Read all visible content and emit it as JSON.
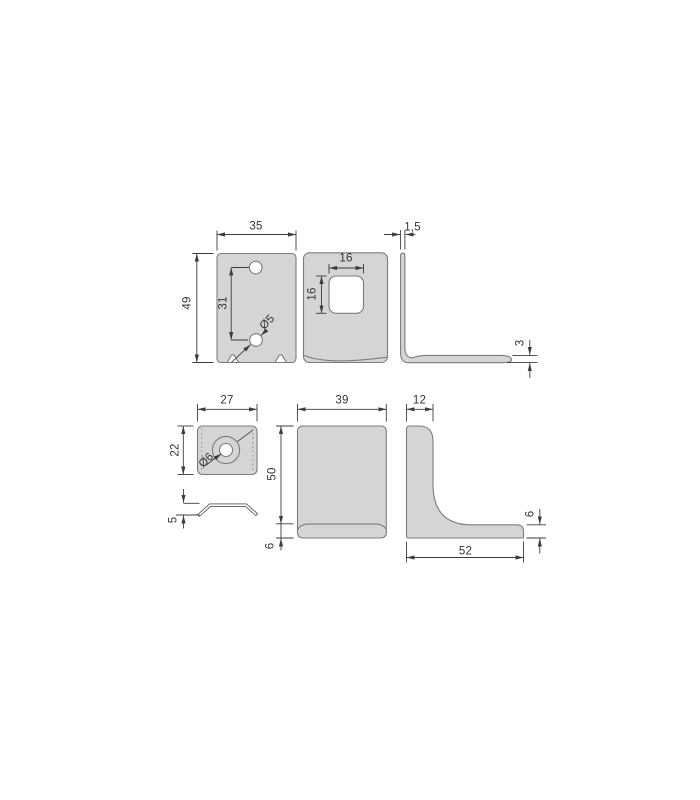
{
  "drawing": {
    "type": "technical-orthographic-views",
    "subject": "metal angle bracket set",
    "units_note": "mm",
    "colors": {
      "background": "#ffffff",
      "part_fill": "#d5d5d5",
      "part_outline": "#7c7c7c",
      "dimension_lines": "#3c3c3c",
      "dimension_text": "#333333"
    }
  },
  "views": {
    "side_plate_front": {
      "width": "35",
      "height": "49",
      "hole_spacing": "31",
      "hole_diameter": "Ø5"
    },
    "front_plate": {
      "cutout_width": "16",
      "cutout_height": "16"
    },
    "profile_top": {
      "thickness": "1,5",
      "lip_height": "3"
    },
    "cover_plate_top": {
      "width": "27",
      "depth": "22",
      "hole_diameter": "Ø6"
    },
    "cover_plate_profile": {
      "height": "5"
    },
    "bracket_front": {
      "width": "39",
      "height": "50",
      "flange_height": "6"
    },
    "bracket_profile": {
      "top_leg_width": "12",
      "base_length": "52",
      "thickness": "6"
    }
  }
}
